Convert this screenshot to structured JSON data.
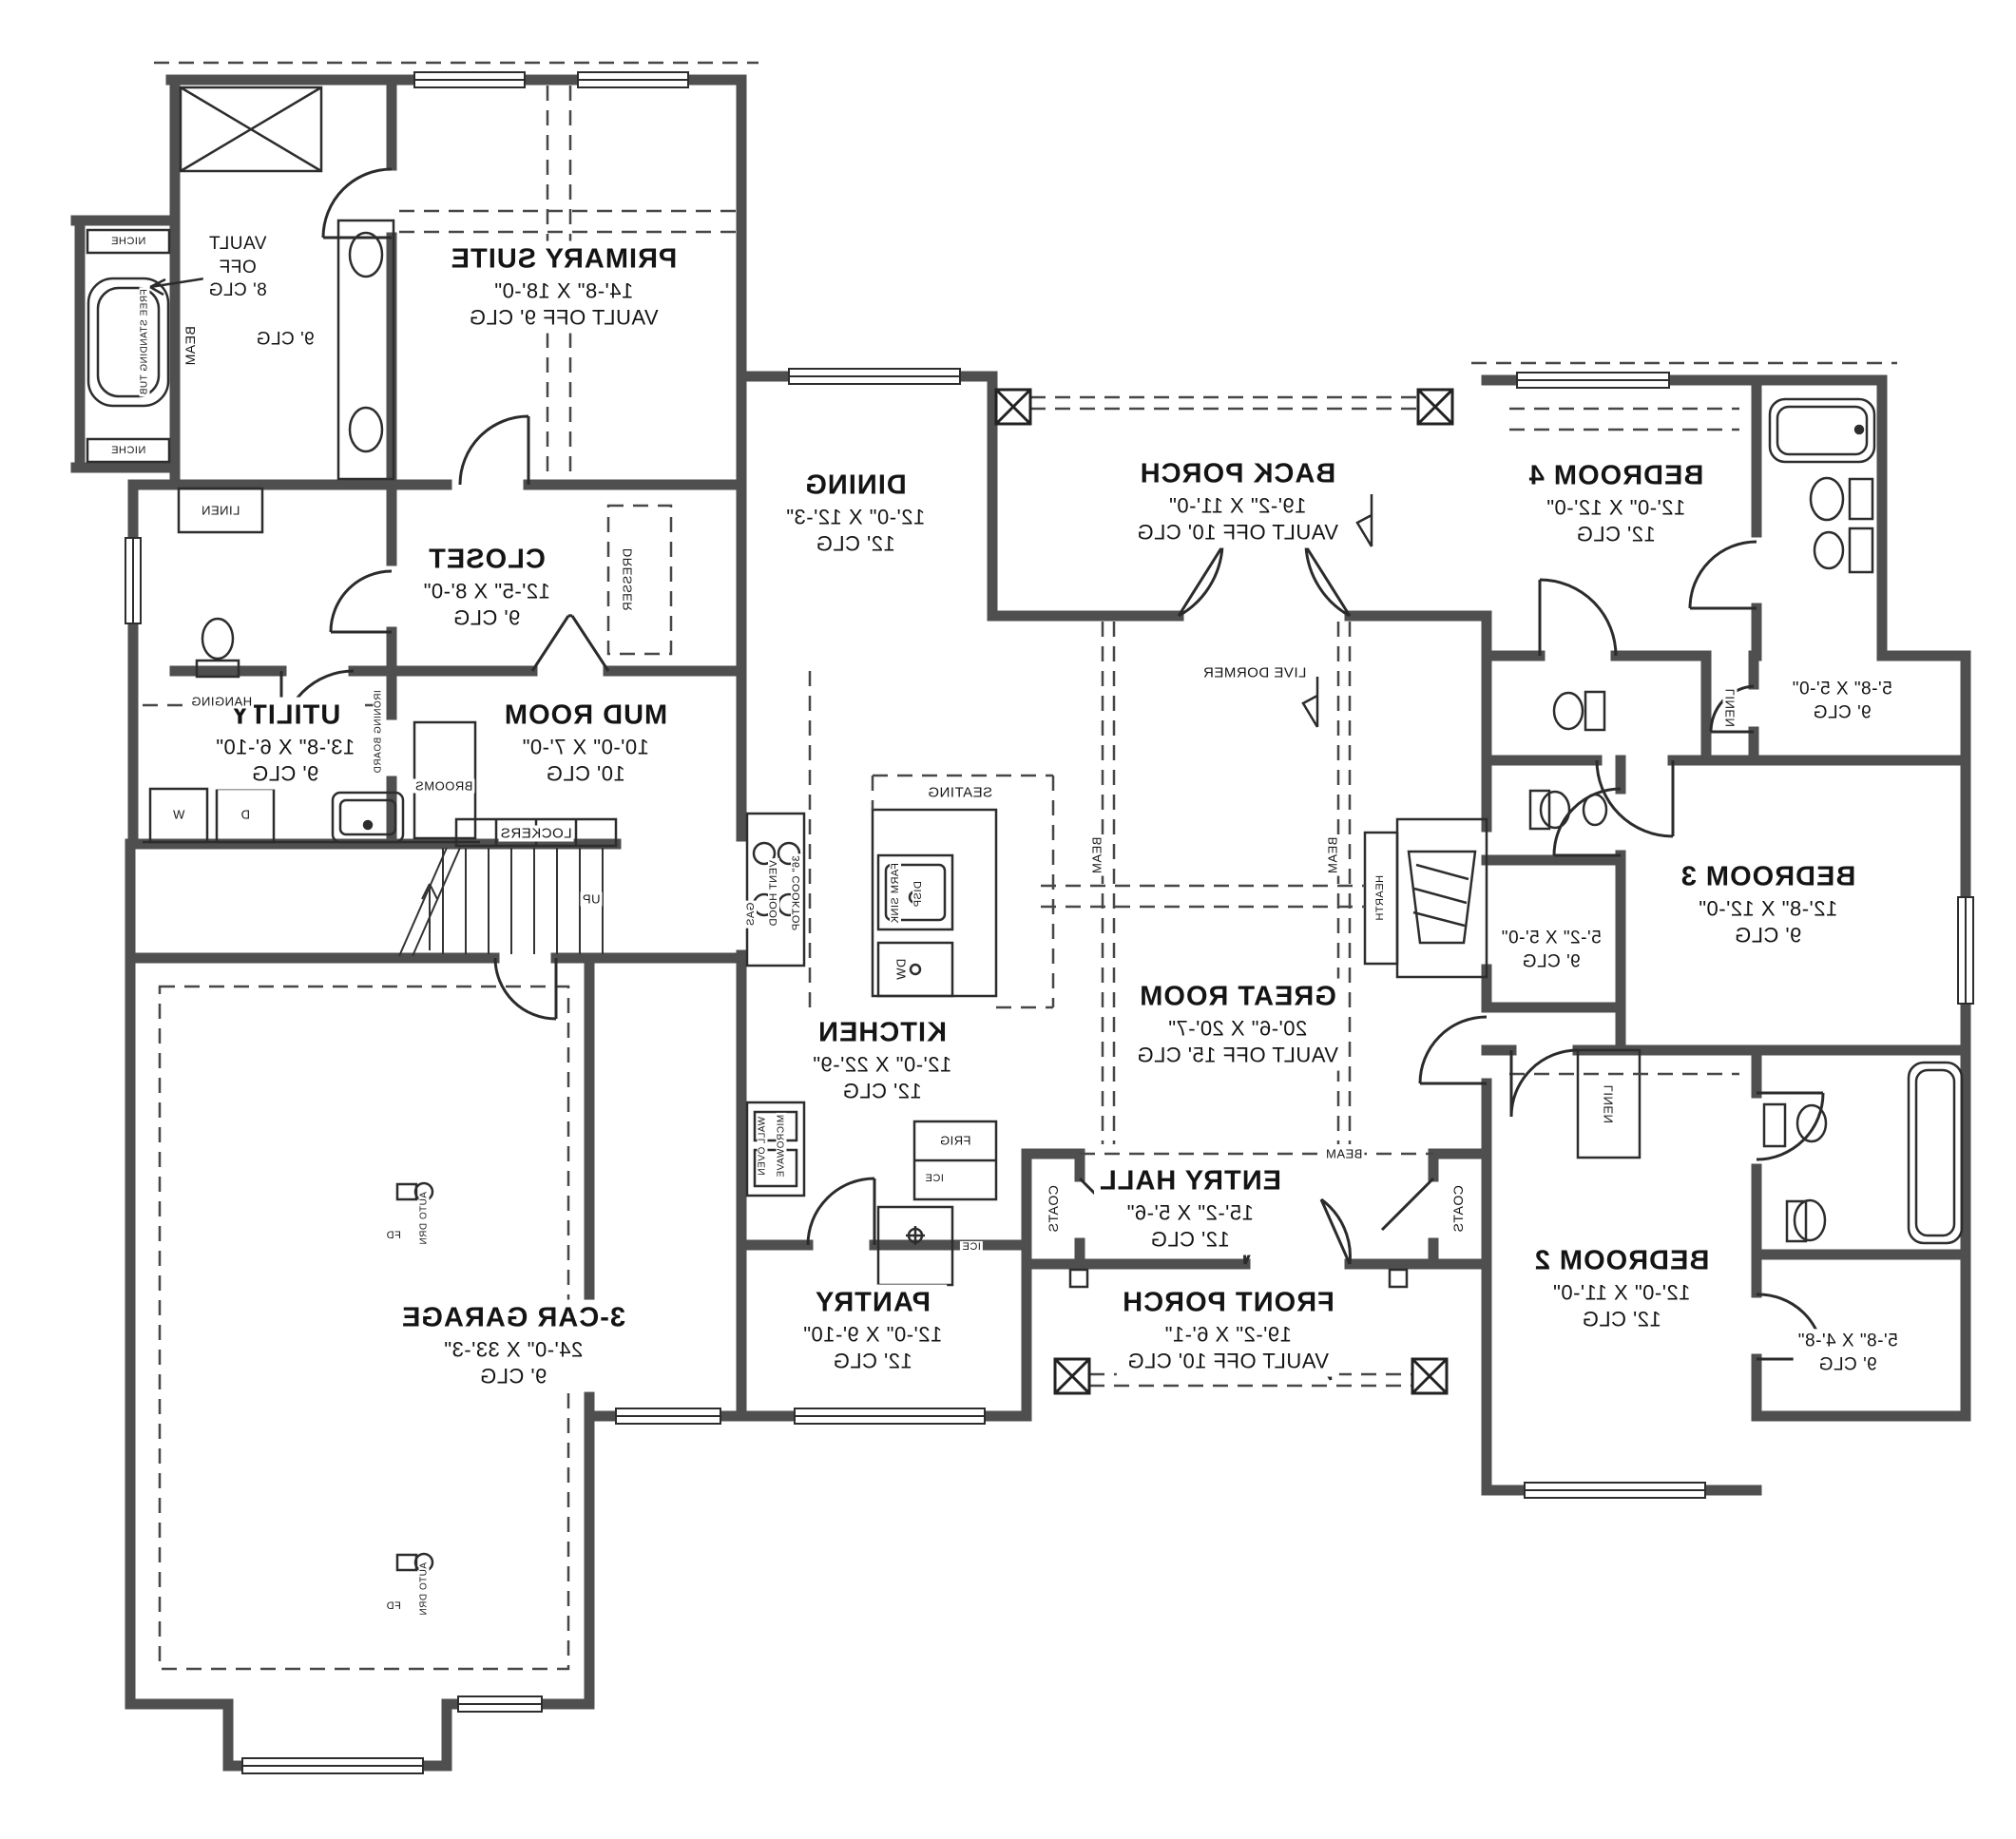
{
  "rooms": {
    "primary_suite": {
      "name": "PRIMARY SUITE",
      "dims": "14'-8\" X 18'-0\"",
      "ceiling": "VAULT OFF 9' CLG"
    },
    "primary_vault_note": {
      "line1": "VAULT",
      "line2": "OFF",
      "line3": "8' CLG"
    },
    "primary_clg_note": "9' CLG",
    "closet": {
      "name": "CLOSET",
      "dims": "12'-5\" X 8'-0\"",
      "ceiling": "9' CLG"
    },
    "utility": {
      "name": "UTILITY",
      "dims": "13'-8\" X 6'-10\"",
      "ceiling": "9' CLG"
    },
    "mud_room": {
      "name": "MUD ROOM",
      "dims": "10'-0\" X 7'-0\"",
      "ceiling": "10' CLG"
    },
    "dining": {
      "name": "DINING",
      "dims": "12'-0\" X 12'-3\"",
      "ceiling": "12' CLG"
    },
    "kitchen": {
      "name": "KITCHEN",
      "dims": "12'-0\" X 22'-9\"",
      "ceiling": "12' CLG"
    },
    "pantry": {
      "name": "PANTRY",
      "dims": "12'-0\" X 9'-10\"",
      "ceiling": "12' CLG"
    },
    "great_room": {
      "name": "GREAT ROOM",
      "dims": "20'-6\" X 20'-7\"",
      "ceiling": "VAULT OFF 15' CLG"
    },
    "entry_hall": {
      "name": "ENTRY HALL",
      "dims": "15'-2\" X 5'-6\"",
      "ceiling": "12' CLG"
    },
    "back_porch": {
      "name": "BACK PORCH",
      "dims": "19'-2\" X 11'-0\"",
      "ceiling": "VAULT OFF 10' CLG"
    },
    "front_porch": {
      "name": "FRONT PORCH",
      "dims": "19'-2\" X 6'-1\"",
      "ceiling": "VAULT OFF 10' CLG"
    },
    "garage": {
      "name": "3-CAR GARAGE",
      "dims": "24'-0\" X 33'-3\"",
      "ceiling": "9' CLG"
    },
    "bedroom_2": {
      "name": "BEDROOM 2",
      "dims": "12'-0\" X 11'-0\"",
      "ceiling": "12' CLG"
    },
    "bedroom_3": {
      "name": "BEDROOM 3",
      "dims": "12'-8\" X 12'-0\"",
      "ceiling": "9' CLG"
    },
    "bedroom_4": {
      "name": "BEDROOM 4",
      "dims": "12'-0\" X 12'-0\"",
      "ceiling": "12' CLG"
    },
    "closet_bed4": {
      "dims": "5'-8\" X 5'-0\"",
      "ceiling": "9' CLG"
    },
    "closet_bed3": {
      "dims": "5'-2\" X 5'-0\"",
      "ceiling": "9' CLG"
    },
    "closet_bed2": {
      "dims": "5'-8\" X 4'-8\"",
      "ceiling": "9' CLG"
    }
  },
  "annotations": {
    "niche": "NICHE",
    "beam": "BEAM",
    "linen": "LINEN",
    "hanging": "HANGING",
    "dresser": "DRESSER",
    "free_standing_tub": "FREE STANDING TUB",
    "ironing_board": "IRONING BOARD",
    "washer": "W",
    "dryer": "D",
    "brooms": "BROOMS",
    "lockers": "LOCKERS",
    "up": "UP",
    "seating": "SEATING",
    "farm_sink": "FARM SINK",
    "disp": "DISP",
    "dw": "DW",
    "gas": "GAS",
    "vent_hood": "VENT HOOD",
    "cooktop": "36\" COOKTOP",
    "wall_oven": "WALL OVEN",
    "microwave": "MICROWAVE",
    "frig": "FRIG",
    "ice": "ICE",
    "coats": "COATS",
    "hearth": "HEARTH",
    "live_dormer": "LIVE DORMER",
    "auto_drain": "AUTO DRN",
    "floor_drain": "FD"
  }
}
